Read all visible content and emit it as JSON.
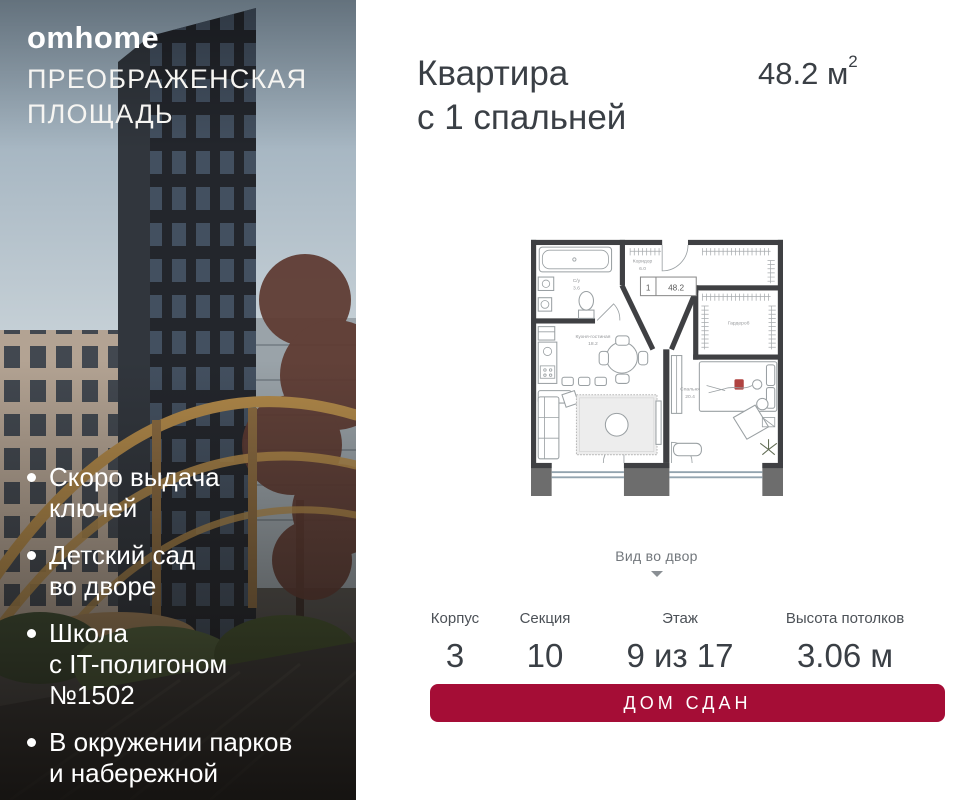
{
  "brand": {
    "logo": "omhome",
    "project_line1": "ПРЕОБРАЖЕНСКАЯ",
    "project_line2": "ПЛОЩАДЬ"
  },
  "features": [
    {
      "line1": "Скоро выдача",
      "line2": "ключей"
    },
    {
      "line1": "Детский сад",
      "line2": "во дворе"
    },
    {
      "line1": "Школа",
      "line2": "с IT-полигоном",
      "line3": "№1502"
    },
    {
      "line1": "В окружении парков",
      "line2": "и набережной"
    }
  ],
  "header": {
    "title_line1": "Квартира",
    "title_line2": "с 1 спальней",
    "area_value": "48.2 м",
    "area_sup": "2"
  },
  "plan": {
    "tag_number": "1",
    "tag_area": "48.2",
    "rooms": {
      "bath_name": "С/у",
      "bath_area": "3.6",
      "hall_name": "Коридор",
      "hall_area": "6.0",
      "kitchen_name": "Кухня-гостиная",
      "kitchen_area": "18.2",
      "bedroom_name": "Спальня",
      "bedroom_area": "20.4",
      "wardrobe_name": "Гардероб"
    },
    "view_label": "Вид во двор"
  },
  "stats": [
    {
      "label": "Корпус",
      "value": "3"
    },
    {
      "label": "Секция",
      "value": "10"
    },
    {
      "label": "Этаж",
      "value": "9 из 17"
    },
    {
      "label": "Высота потолков",
      "value": "3.06 м"
    }
  ],
  "cta": {
    "label": "ДОМ СДАН"
  },
  "colors": {
    "accent": "#a50d36",
    "text_dark": "#3a3f45"
  }
}
